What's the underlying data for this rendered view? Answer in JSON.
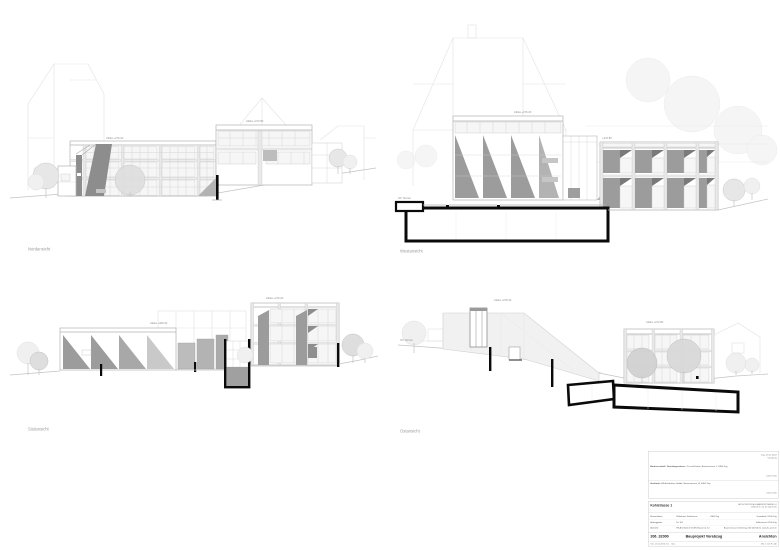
{
  "sheet": {
    "background": "#ffffff"
  },
  "views": [
    {
      "id": "nordansicht",
      "label": "Nordansicht",
      "annotations": [
        "Attika +476.20",
        "Attika +472.80"
      ]
    },
    {
      "id": "westansicht",
      "label": "Westansicht",
      "annotations": [
        "Attika +476.20",
        "+472.80",
        "OK Terrain"
      ]
    },
    {
      "id": "suedansicht",
      "label": "Südansicht",
      "annotations": [
        "Attika +476.20",
        "Attika +469.40"
      ]
    },
    {
      "id": "ostansicht",
      "label": "Ostansicht",
      "annotations": [
        "Attika +478.40",
        "Attika +472.80",
        "OK Terrain"
      ]
    }
  ],
  "title_block": {
    "approval": {
      "date_line1": "Zug, 23.11.2022",
      "date_line2": "Vorabzug",
      "owner_label": "Bauherrschaft / Grundeigentümer:",
      "owner_text": "Ort und Datum, Baarerstrasse 1, 6300 Zug",
      "owner_sign": "Unterschrift",
      "architect_label": "Architekt:",
      "architect_text": "HS Architekten GmbH, Baarerstrasse 14, 6300 Zug",
      "architect_sign": "Unterschrift"
    },
    "project": {
      "title": "Kohlstrasse 1",
      "office_line1": "ARCHITEKTEN AG BAARERSTRASSE 14",
      "office_line2": "6300 ZUG +41 41 000 00 00",
      "rows": [
        {
          "label": "Bauvorhaben",
          "value": "Wohnhaus Kohlstrasse",
          "value2": "6300 Zug",
          "right": "Grundbuch 1/100 Zug"
        },
        {
          "label": "Auftraggeber",
          "value": "Nr. 101",
          "value2": "",
          "right": "Kohlstrasse 1/100 Zug"
        },
        {
          "label": "Architekt",
          "value": "HS Architekten GmbH, Baarerstr. 14",
          "value2": "",
          "right": "Baarerstrasse 1/100 Zug, 041 000 00 00, www.hs-arch.ch"
        }
      ],
      "plan_number": "206_32000",
      "plan_phase": "Bauprojekt Vorabzug",
      "plan_title": "Ansichten",
      "footer_left": "Gez.   23.11.2022   mm",
      "footer_mid": "Geä.",
      "footer_right": "Mst.   1:100      Fo.   A0"
    }
  },
  "colors": {
    "linework": "#c3c3c3",
    "shading_dark": "#8d8d8d",
    "shading_mid": "#9c9c9c",
    "shading_light": "#b3b3b3",
    "section_cut": "#0a0a0a",
    "annotation_text": "#8f8f8f",
    "titleblock_border": "#b5b5b5"
  }
}
